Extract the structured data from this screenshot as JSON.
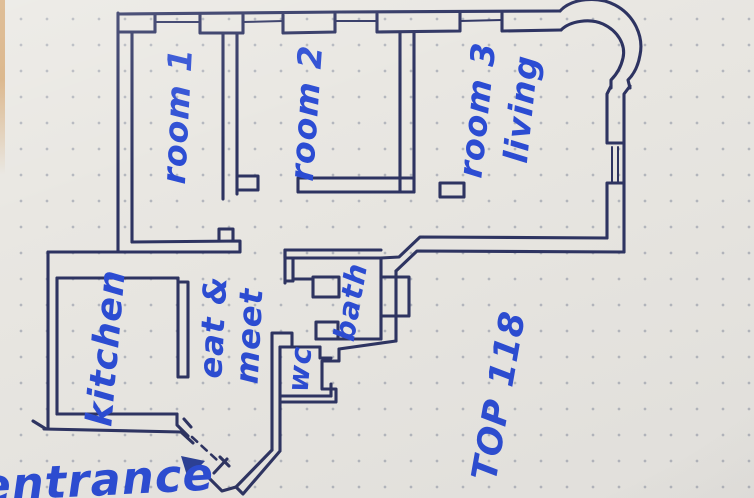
{
  "plan": {
    "type": "hand-drawn apartment floor plan on dotted notepad paper",
    "labels": {
      "room1": "room 1",
      "room2": "room 2",
      "room3": "room 3",
      "room3_sub": "living",
      "kitchen": "kitchen",
      "eat": "eat &",
      "meet": "meet",
      "wc": "wc",
      "bath": "bath",
      "unit": "TOP 118",
      "entrance": "entrance"
    },
    "colors": {
      "paper": "#e9e7e2",
      "wall_ink": "#2d3361",
      "label_ink": "#2b4cd3",
      "arrow_ink": "#2a3f96",
      "dot": "#a7abb5",
      "photo_edge": "#d7ae7e"
    }
  }
}
